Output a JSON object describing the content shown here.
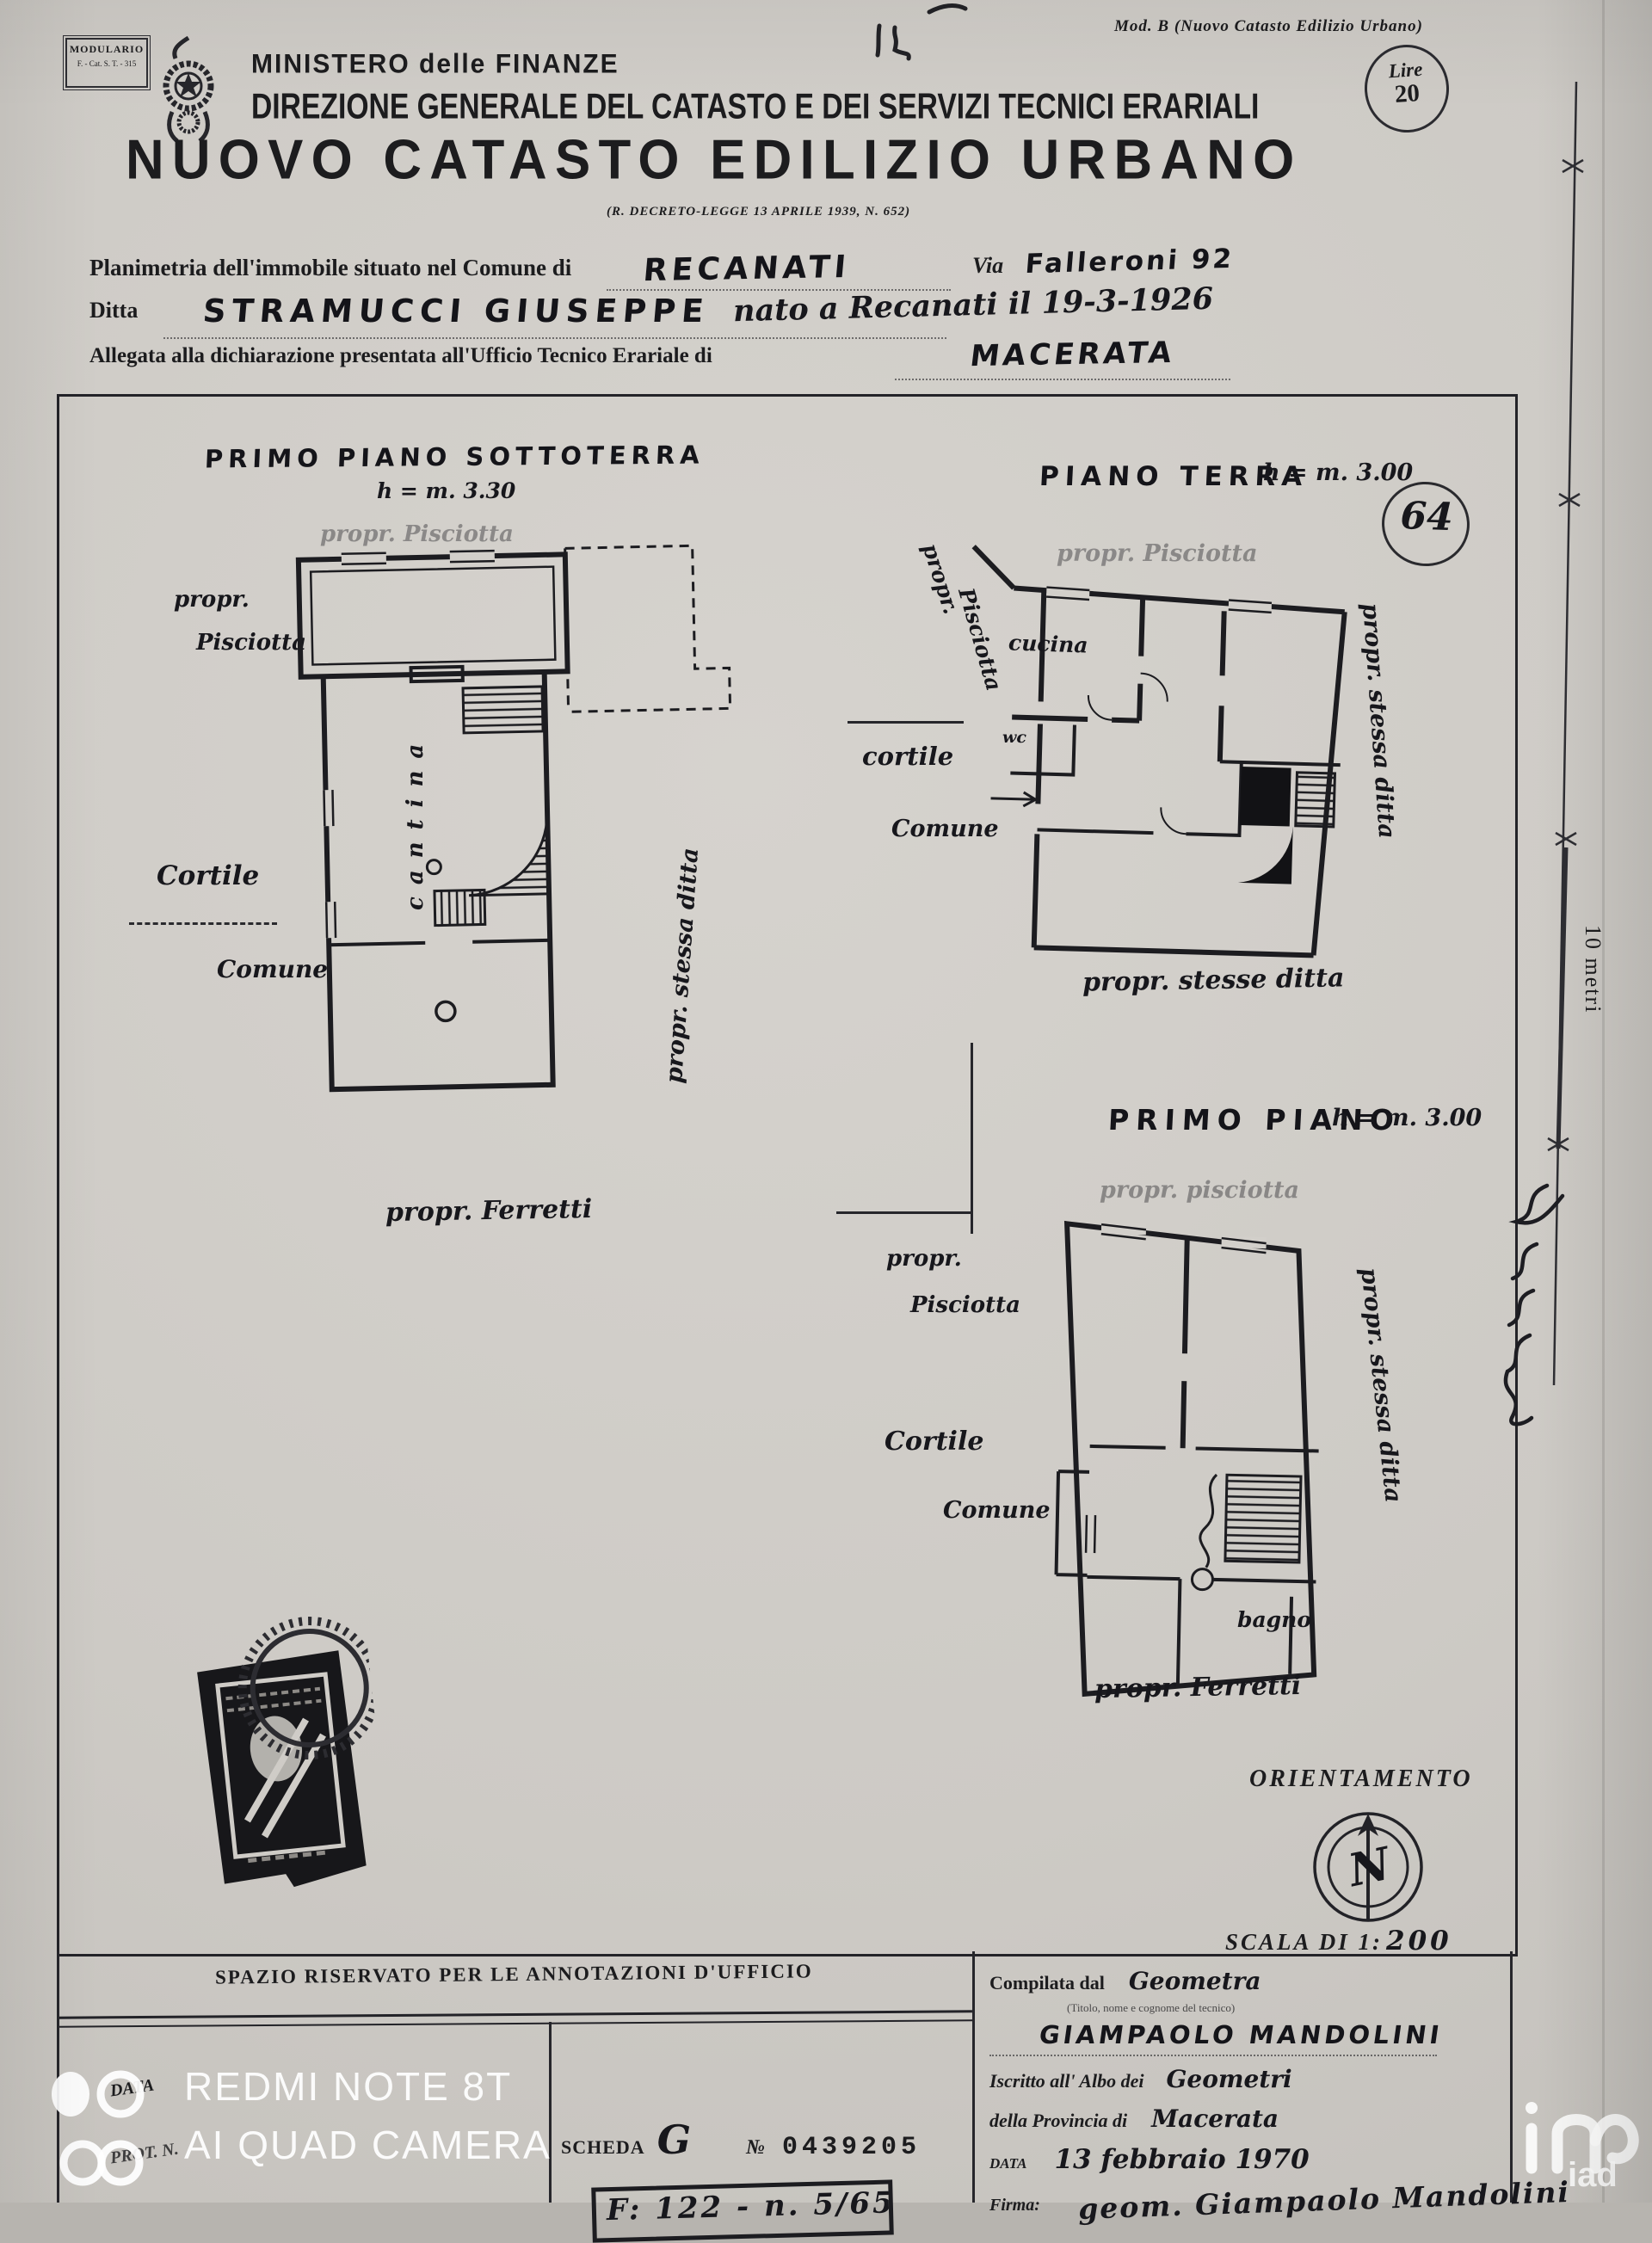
{
  "header": {
    "modulario_title": "MODULARIO",
    "modulario_sub": "F. - Cat. S. T. - 315",
    "mod_b": "Mod. B (Nuovo Catasto Edilizio Urbano)",
    "ministry": "MINISTERO delle FINANZE",
    "direction": "DIREZIONE GENERALE DEL CATASTO E DEI SERVIZI TECNICI ERARIALI",
    "lire_label": "Lire",
    "lire_value": "20",
    "title": "NUOVO CATASTO EDILIZIO URBANO",
    "decree": "(R. DECRETO-LEGGE 13 APRILE 1939, N. 652)"
  },
  "form": {
    "line1_label": "Planimetria dell'immobile situato nel Comune di",
    "line1_value": "RECANATI",
    "via_label": "Via",
    "via_value": "Falleroni 92",
    "line2_label": "Ditta",
    "line2_value": "STRAMUCCI GIUSEPPE",
    "line2_value2": "nato a Recanati il 19-3-1926",
    "line3_label": "Allegata alla dichiarazione presentata all'Ufficio Tecnico Erariale di",
    "line3_value": "MACERATA"
  },
  "plans": {
    "basement": {
      "title": "PRIMO PIANO SOTTOTERRA",
      "height": "h = m. 3.30",
      "top_label": "propr. Pisciotta",
      "left1": "propr.",
      "left2": "Pisciotta",
      "court1": "Cortile",
      "court2": "Comune",
      "room": "cantina",
      "right_label": "propr. stessa ditta",
      "bottom_label": "propr. Ferretti"
    },
    "ground": {
      "title": "PIANO TERRA",
      "height": "h = m. 3.00",
      "badge": "64",
      "top_label": "propr. Pisciotta",
      "left1": "propr.",
      "left2": "Pisciotta",
      "court1": "cortile",
      "court2": "Comune",
      "room_kitchen": "cucina",
      "room_wc": "wc",
      "right_label": "propr. stessa ditta",
      "bottom_label": "propr. stesse ditta"
    },
    "first": {
      "title": "PRIMO PIANO",
      "height": "h = m. 3.00",
      "top_label": "propr. pisciotta",
      "left1": "propr.",
      "left2": "Pisciotta",
      "court1": "Cortile",
      "court2": "Comune",
      "room_bath": "bagno",
      "right_label": "propr. stessa ditta",
      "bottom_label": "propr. Ferretti"
    }
  },
  "orientation": {
    "title": "ORIENTAMENTO",
    "compass_letter": "N",
    "scale_label": "SCALA DI 1:",
    "scale_value": "200"
  },
  "ruler": {
    "label": "10 metri"
  },
  "office": {
    "header": "SPAZIO RISERVATO PER LE ANNOTAZIONI D'UFFICIO",
    "data_label": "DATA",
    "prot_label": "PROT. N.",
    "scheda_label": "SCHEDA",
    "scheda_value": "G",
    "number_sign": "№",
    "number_value": "0439205",
    "stamp_text": "F: 122 - n. 5/65"
  },
  "compiler": {
    "line1_label": "Compilata dal",
    "line1_value": "Geometra",
    "subtitle": "(Titolo, nome e cognome del tecnico)",
    "name": "GIAMPAOLO MANDOLINI",
    "line3_label": "Iscritto all' Albo dei",
    "line3_value": "Geometri",
    "line4_label": "della Provincia di",
    "line4_value": "Macerata",
    "date_label": "DATA",
    "date_value": "13 febbraio 1970",
    "firma_label": "Firma:",
    "firma_value": "geom. Giampaolo Mandolini"
  },
  "watermark": {
    "camera_line1": "REDMI NOTE 8T",
    "camera_line2": "AI QUAD CAMERA",
    "agency": "iad"
  }
}
